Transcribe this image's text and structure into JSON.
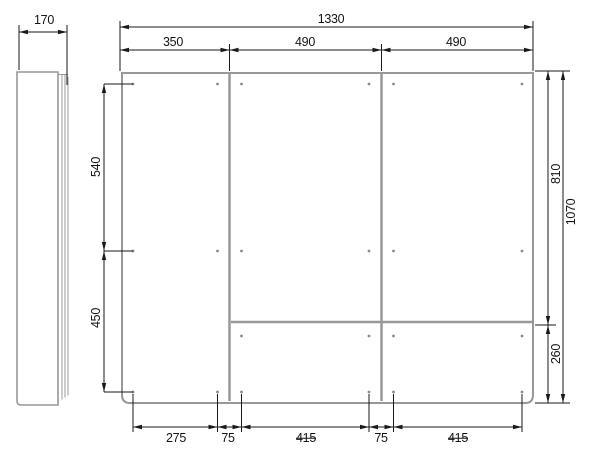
{
  "drawing": {
    "side_view": {
      "depth": "170"
    },
    "front_view": {
      "overall_width": "1330",
      "column_widths": [
        "350",
        "490",
        "490"
      ],
      "left_heights": {
        "upper": "540",
        "lower": "450"
      },
      "right_heights": {
        "upper": "810",
        "overall": "1070",
        "lower": "260"
      },
      "bottom_spacings": [
        "275",
        "75",
        "415",
        "75",
        "415"
      ]
    }
  },
  "colors": {
    "panel_line": "#989898",
    "dim_line": "#1a1a1a",
    "hole_color": "#8a8a8a",
    "background": "#ffffff"
  }
}
